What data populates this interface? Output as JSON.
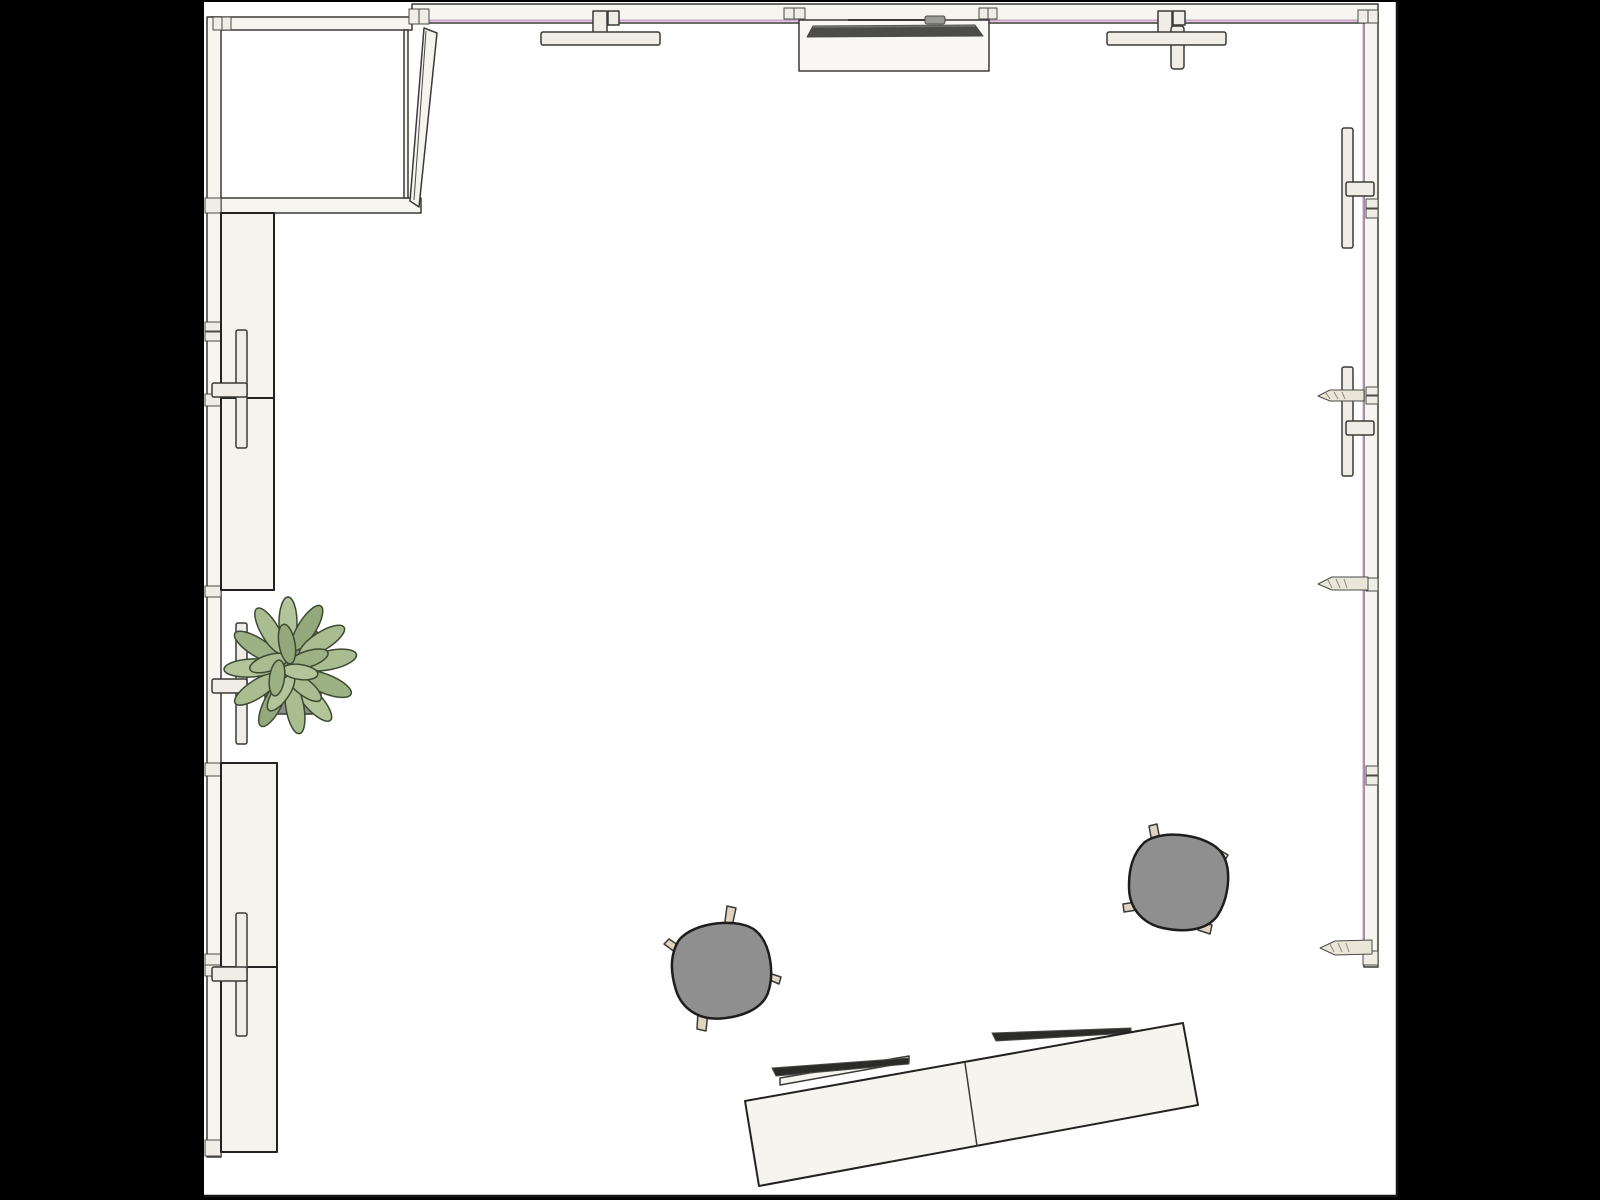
{
  "scene": {
    "view": "top-down-floor-plan",
    "room": "studio-room-with-closet",
    "objects": [
      "closet-top-left",
      "door-ajar",
      "left-wall-cabinets",
      "potted-plant",
      "window-crank-handles",
      "wall-mounted-tv",
      "stool",
      "stool",
      "two-seat-desk",
      "desk-screens",
      "wall-pencil-ledges"
    ]
  },
  "colors": {
    "letterbox": "#000000",
    "floor": "#ffffff",
    "border": "#161616",
    "wall": "#f6f5f0",
    "fixture": "#efede5",
    "cabinet": "#f4f3ee",
    "glass": "#c193c1",
    "door": "#f5f4ef",
    "tv_console": "#f8f7f3",
    "tv_screen": "#4c4c48",
    "tv_accessory": "#9a9a96",
    "pencil": "#eae5d9",
    "plant_pot": "#8c8c8a",
    "stool_seat": "#8f8f8f",
    "stool_leg": "#ddd4c2",
    "desk": "#f5f4ef",
    "desk_screen": "#2b2b29"
  },
  "plant": {
    "leaves": [
      {
        "x": 330,
        "y": 660,
        "rx": 27,
        "ry": 9.5,
        "a": -12,
        "c": "#a9bd90"
      },
      {
        "x": 326,
        "y": 684,
        "rx": 27,
        "ry": 9.5,
        "a": 22,
        "c": "#9cb184"
      },
      {
        "x": 313,
        "y": 701,
        "rx": 26,
        "ry": 9,
        "a": 48,
        "c": "#b2c49a"
      },
      {
        "x": 295,
        "y": 708,
        "rx": 26,
        "ry": 9,
        "a": 80,
        "c": "#a9bd90"
      },
      {
        "x": 273,
        "y": 703,
        "rx": 26,
        "ry": 9,
        "a": 117,
        "c": "#93a97b"
      },
      {
        "x": 257,
        "y": 689,
        "rx": 26,
        "ry": 9,
        "a": 147,
        "c": "#a9bd90"
      },
      {
        "x": 251,
        "y": 668,
        "rx": 27,
        "ry": 9,
        "a": 177,
        "c": "#b2c49a"
      },
      {
        "x": 257,
        "y": 647,
        "rx": 26,
        "ry": 9,
        "a": -148,
        "c": "#9cb184"
      },
      {
        "x": 270,
        "y": 631,
        "rx": 26,
        "ry": 9,
        "a": -120,
        "c": "#a9bd90"
      },
      {
        "x": 288,
        "y": 623,
        "rx": 26,
        "ry": 9,
        "a": -90,
        "c": "#b2c49a"
      },
      {
        "x": 307,
        "y": 628,
        "rx": 26,
        "ry": 9,
        "a": -58,
        "c": "#93a97b"
      },
      {
        "x": 322,
        "y": 641,
        "rx": 26,
        "ry": 9,
        "a": -32,
        "c": "#a9bd90"
      },
      {
        "x": 308,
        "y": 659,
        "rx": 21,
        "ry": 8,
        "a": -18,
        "c": "#9cb184"
      },
      {
        "x": 304,
        "y": 687,
        "rx": 21,
        "ry": 8,
        "a": 38,
        "c": "#a9bd90"
      },
      {
        "x": 281,
        "y": 693,
        "rx": 21,
        "ry": 8,
        "a": 125,
        "c": "#b2c49a"
      },
      {
        "x": 269,
        "y": 663,
        "rx": 20,
        "ry": 8,
        "a": 162,
        "c": "#a9bd90"
      },
      {
        "x": 287,
        "y": 644,
        "rx": 20,
        "ry": 8,
        "a": -100,
        "c": "#93a97b"
      },
      {
        "x": 300,
        "y": 672,
        "rx": 18,
        "ry": 7.5,
        "a": 8,
        "c": "#b2c49a"
      },
      {
        "x": 277,
        "y": 678,
        "rx": 18,
        "ry": 7.5,
        "a": 98,
        "c": "#9cb184"
      }
    ]
  }
}
